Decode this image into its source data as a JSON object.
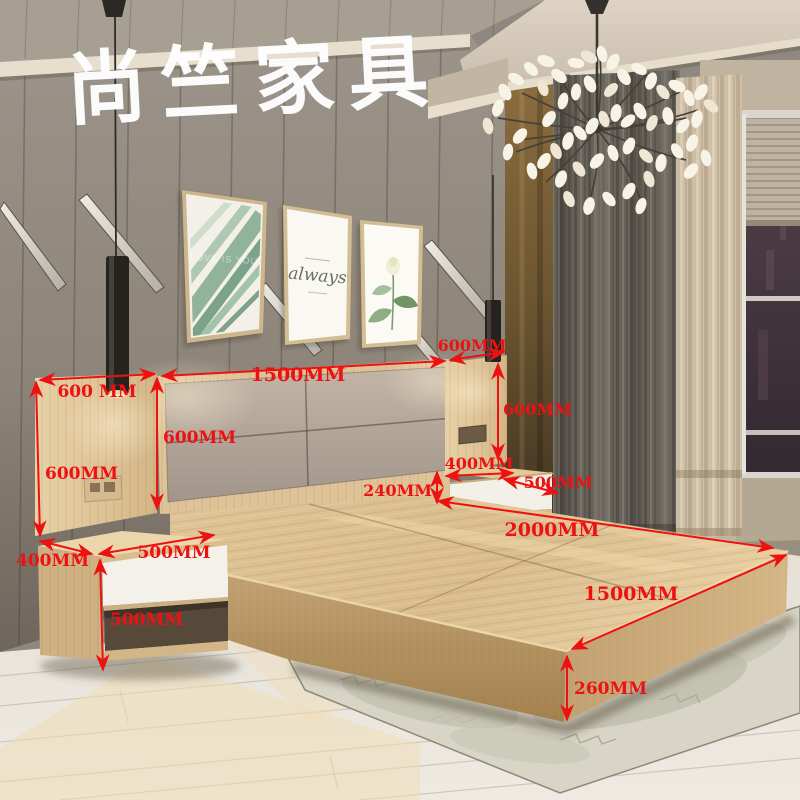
{
  "watermark": {
    "text": "尚竺家具"
  },
  "artworks": {
    "frame1_text": "LOVE IS YOU",
    "frame2_text": "always"
  },
  "dimensions": {
    "color": "#ee1111",
    "unit": "MM",
    "labels": [
      {
        "id": "left-panel-width",
        "text": "600 MM"
      },
      {
        "id": "headboard-height",
        "text": "600MM"
      },
      {
        "id": "left-panel-height",
        "text": "600MM"
      },
      {
        "id": "headboard-width",
        "text": "1500MM"
      },
      {
        "id": "right-panel-width",
        "text": "600MM"
      },
      {
        "id": "right-panel-height",
        "text": "600MM"
      },
      {
        "id": "right-nightstand-depth",
        "text": "400MM"
      },
      {
        "id": "right-nightstand-width",
        "text": "500MM"
      },
      {
        "id": "bed-platform-height-side",
        "text": "240MM"
      },
      {
        "id": "bed-length",
        "text": "2000MM"
      },
      {
        "id": "bed-width",
        "text": "1500MM"
      },
      {
        "id": "bed-platform-height-front",
        "text": "260MM"
      },
      {
        "id": "left-nightstand-depth",
        "text": "400MM"
      },
      {
        "id": "left-nightstand-width",
        "text": "500MM"
      },
      {
        "id": "left-nightstand-height",
        "text": "500MM"
      }
    ]
  }
}
